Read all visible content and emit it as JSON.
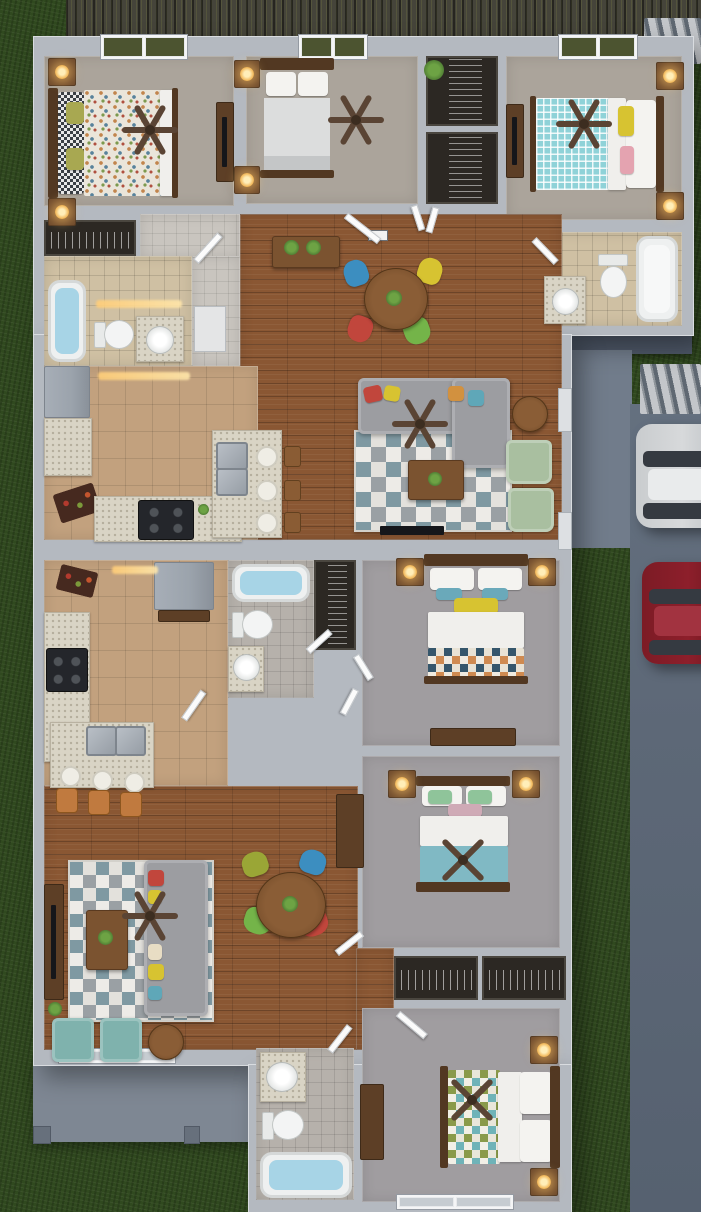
{
  "scene": {
    "type": "3d-floor-plan-rendering",
    "view": "top-down-aerial",
    "units_count": 2
  },
  "palette": {
    "grass": "#30491f",
    "fence": "#45443a",
    "picket": "#c3c6ca",
    "driveway": "#5d6877",
    "patio": "#717c8b",
    "porch": "#7e8793",
    "wall": "#b4b9c0",
    "wallEdge": "#d9dce0",
    "wood": "#8a5733",
    "tileKitchen": "#c2a17e",
    "tileBeige": "#cfc0a3",
    "tileGray": "#b6b1ab",
    "carpetA": "#aba49b",
    "carpetB": "#a09da0",
    "counter": "#d9d4c5",
    "appliance": "#9ba3ac",
    "stove": "#24262b",
    "sofa": "#9c9da1",
    "chairSageGreen": "#a9bfa0",
    "chairTeal": "#7fb2ad",
    "chairBlue": "#3c8ec0",
    "chairYellow": "#d7c331",
    "chairRed": "#c1463c",
    "chairGreen": "#74b449",
    "chairOlive": "#9aa636",
    "stoolOrange": "#c07a3f",
    "tableWood": "#7b5330",
    "darkWood": "#523822",
    "fan": "#5a4434",
    "water": "#a7d4e6",
    "porcelain": "#f3f4f4",
    "lampGlow": "#f7c766",
    "plant": "#4d7a33",
    "rugLight": "#e3e1dc",
    "rugMid": "#9aa0a4",
    "rugTeal": "#7f99a2",
    "quiltTealCheck": "#8fd2d8",
    "blanketTeal": "#80b9c4",
    "bedWhite": "#f0efec",
    "carWhite": "#d7d9db",
    "carRed": "#8d1f2b"
  },
  "exterior": {
    "landscape": [
      "lawn",
      "privacy-fence",
      "picket-gate",
      "side-walkway",
      "driveway",
      "rear-porch"
    ],
    "vehicles": [
      {
        "name": "white-suv",
        "color": "#d7d9db"
      },
      {
        "name": "red-sedan",
        "color": "#8d1f2b"
      }
    ]
  },
  "unit_top": {
    "rooms": [
      "bedroom-left",
      "bedroom-middle",
      "bedroom-right",
      "hall-closets",
      "bathroom-left",
      "bathroom-right",
      "kitchen",
      "dining-area",
      "living-room",
      "entry-hall"
    ],
    "furniture": [
      "queen-bed-multicolor-quilt",
      "queen-bed-gray",
      "queen-bed-teal-check",
      "ceiling-fans",
      "nightstands-with-lamps",
      "tv-console",
      "round-dining-table",
      "four-color-dining-chairs",
      "entry-console-with-plants",
      "sectional-sofa",
      "two-sage-armchairs",
      "coffee-table",
      "geometric-rug",
      "kitchen-island-two-sinks",
      "bar-stools",
      "refrigerator",
      "cooktop",
      "bathtubs",
      "toilets",
      "vanity-sinks"
    ]
  },
  "unit_bottom": {
    "rooms": [
      "kitchen",
      "hall-bathroom",
      "bedroom-one",
      "bedroom-two",
      "bedroom-three",
      "rear-bathroom",
      "living-room",
      "dining-area",
      "closets",
      "rear-porch"
    ],
    "furniture": [
      "queen-bed-triangle-quilt",
      "queen-bed-teal-blanket",
      "queen-bed-horizontal",
      "ceiling-fans",
      "nightstands-with-lamps",
      "dressers",
      "kitchen-island-double-sink",
      "orange-bar-stools",
      "refrigerator",
      "cooktop",
      "round-dining-table",
      "four-color-dining-chairs",
      "hutch",
      "sofa",
      "two-teal-armchairs",
      "coffee-table",
      "geometric-rug",
      "tv-bench",
      "bathtubs",
      "toilets",
      "pedestal-sink",
      "side-table"
    ]
  }
}
